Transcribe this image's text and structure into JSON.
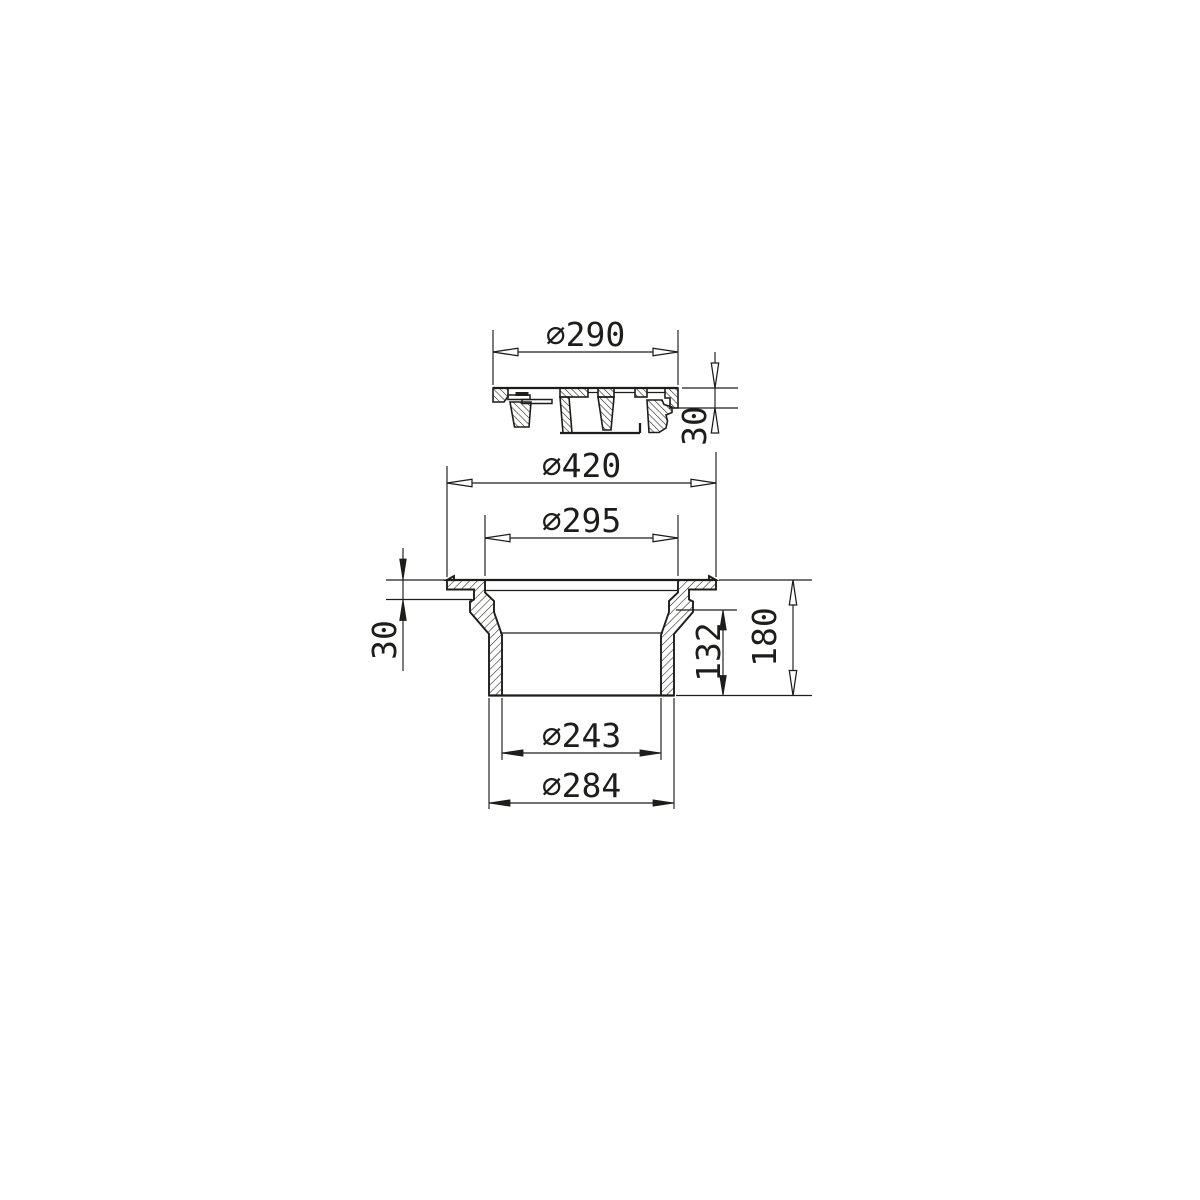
{
  "sheet": {
    "background_color": "#ffffff",
    "line_color": "#1d1d1b",
    "description": "Sectional technical drawing of a circular cover and its drain frame"
  },
  "drawing": {
    "type": "technical-section",
    "parts": [
      {
        "id": "cover",
        "name": "cover-section-view"
      },
      {
        "id": "frame",
        "name": "frame-section-view"
      }
    ],
    "dimensions": {
      "cover_outer_diameter": {
        "label": "∅290",
        "value_mm": 290
      },
      "cover_height": {
        "label": "30",
        "value_mm": 30
      },
      "frame_flange_diameter": {
        "label": "∅420",
        "value_mm": 420
      },
      "frame_opening_diameter": {
        "label": "∅295",
        "value_mm": 295
      },
      "frame_flange_height": {
        "label": "30",
        "value_mm": 30
      },
      "frame_spigot_height": {
        "label": "132",
        "value_mm": 132
      },
      "frame_total_height": {
        "label": "180",
        "value_mm": 180
      },
      "spigot_inner_diameter": {
        "label": "∅243",
        "value_mm": 243
      },
      "spigot_outer_diameter": {
        "label": "∅284",
        "value_mm": 284
      }
    }
  }
}
